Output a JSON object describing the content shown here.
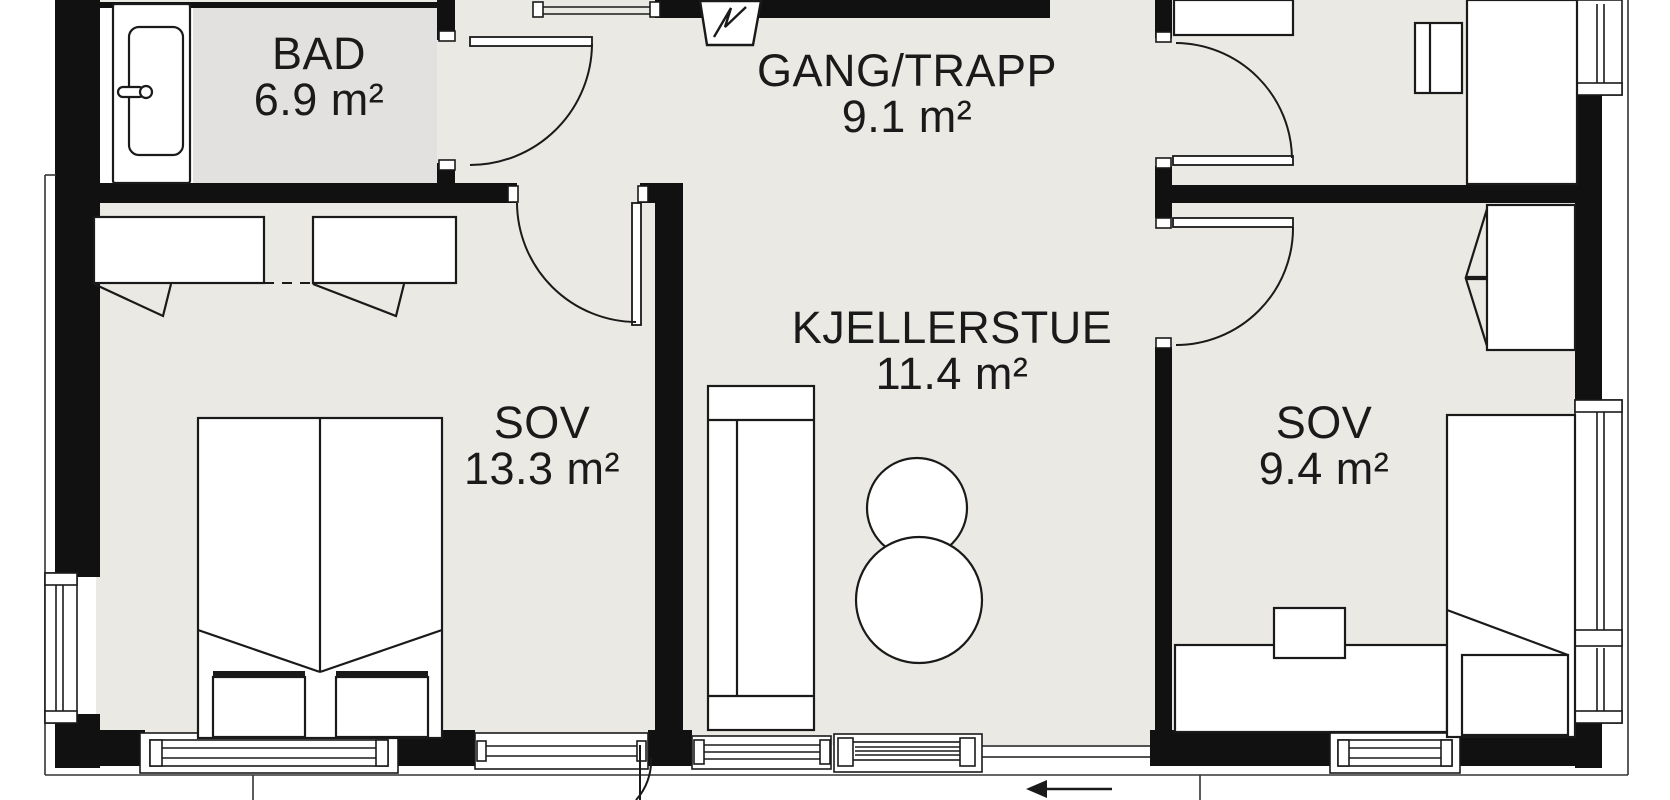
{
  "plan": {
    "type": "floor-plan",
    "rooms": [
      {
        "name": "BAD",
        "area": "6.9 m²"
      },
      {
        "name": "GANG/TRAPP",
        "area": "9.1 m²"
      },
      {
        "name": "KJELLERSTUE",
        "area": "11.4 m²"
      },
      {
        "name": "SOV",
        "area": "13.3 m²"
      },
      {
        "name": "SOV",
        "area": "9.4 m²"
      }
    ],
    "fixtures": [
      "bathtub",
      "wardrobe-double",
      "wardrobe-single",
      "double-bed-with-nightstands",
      "sofa",
      "round-table-small",
      "round-table-large",
      "single-bed-with-chest",
      "desk-with-chair",
      "desk-with-chair-upper",
      "closet-upper"
    ],
    "icons": {
      "electrical_panel": "zigzag-lightning-panel",
      "entrance_arrow": "left-arrow"
    }
  },
  "colors": {
    "floor-color": "#ebe9e3",
    "bad-floor-color": "#e2e1e0",
    "wall-color": "#111111",
    "line-color": "#1a1a1a",
    "page-bg": "#ffffff",
    "label-color": "#1a1a1a"
  }
}
